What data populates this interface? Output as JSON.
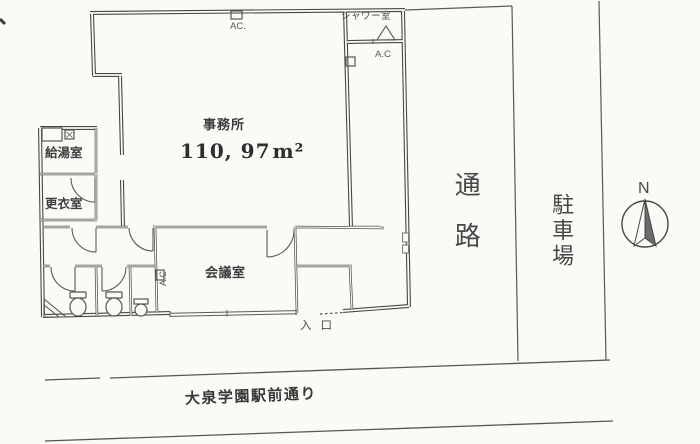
{
  "office": {
    "name": "事務所",
    "area_value": "110, 97",
    "area_unit": "m²"
  },
  "rooms": {
    "shower": "シャワー室",
    "kitchen": "給湯室",
    "changing": "更衣室",
    "meeting": "会議室"
  },
  "ac": {
    "top": "AC.",
    "corridor": "A.C",
    "meeting": "A.C"
  },
  "site": {
    "passage": "通路",
    "parking": "駐車場",
    "entrance": "入口",
    "street": "大泉学園駅前通り"
  },
  "compass": {
    "north": "N"
  },
  "colors": {
    "ink": "#474747",
    "paper": "#fbfaf6"
  }
}
